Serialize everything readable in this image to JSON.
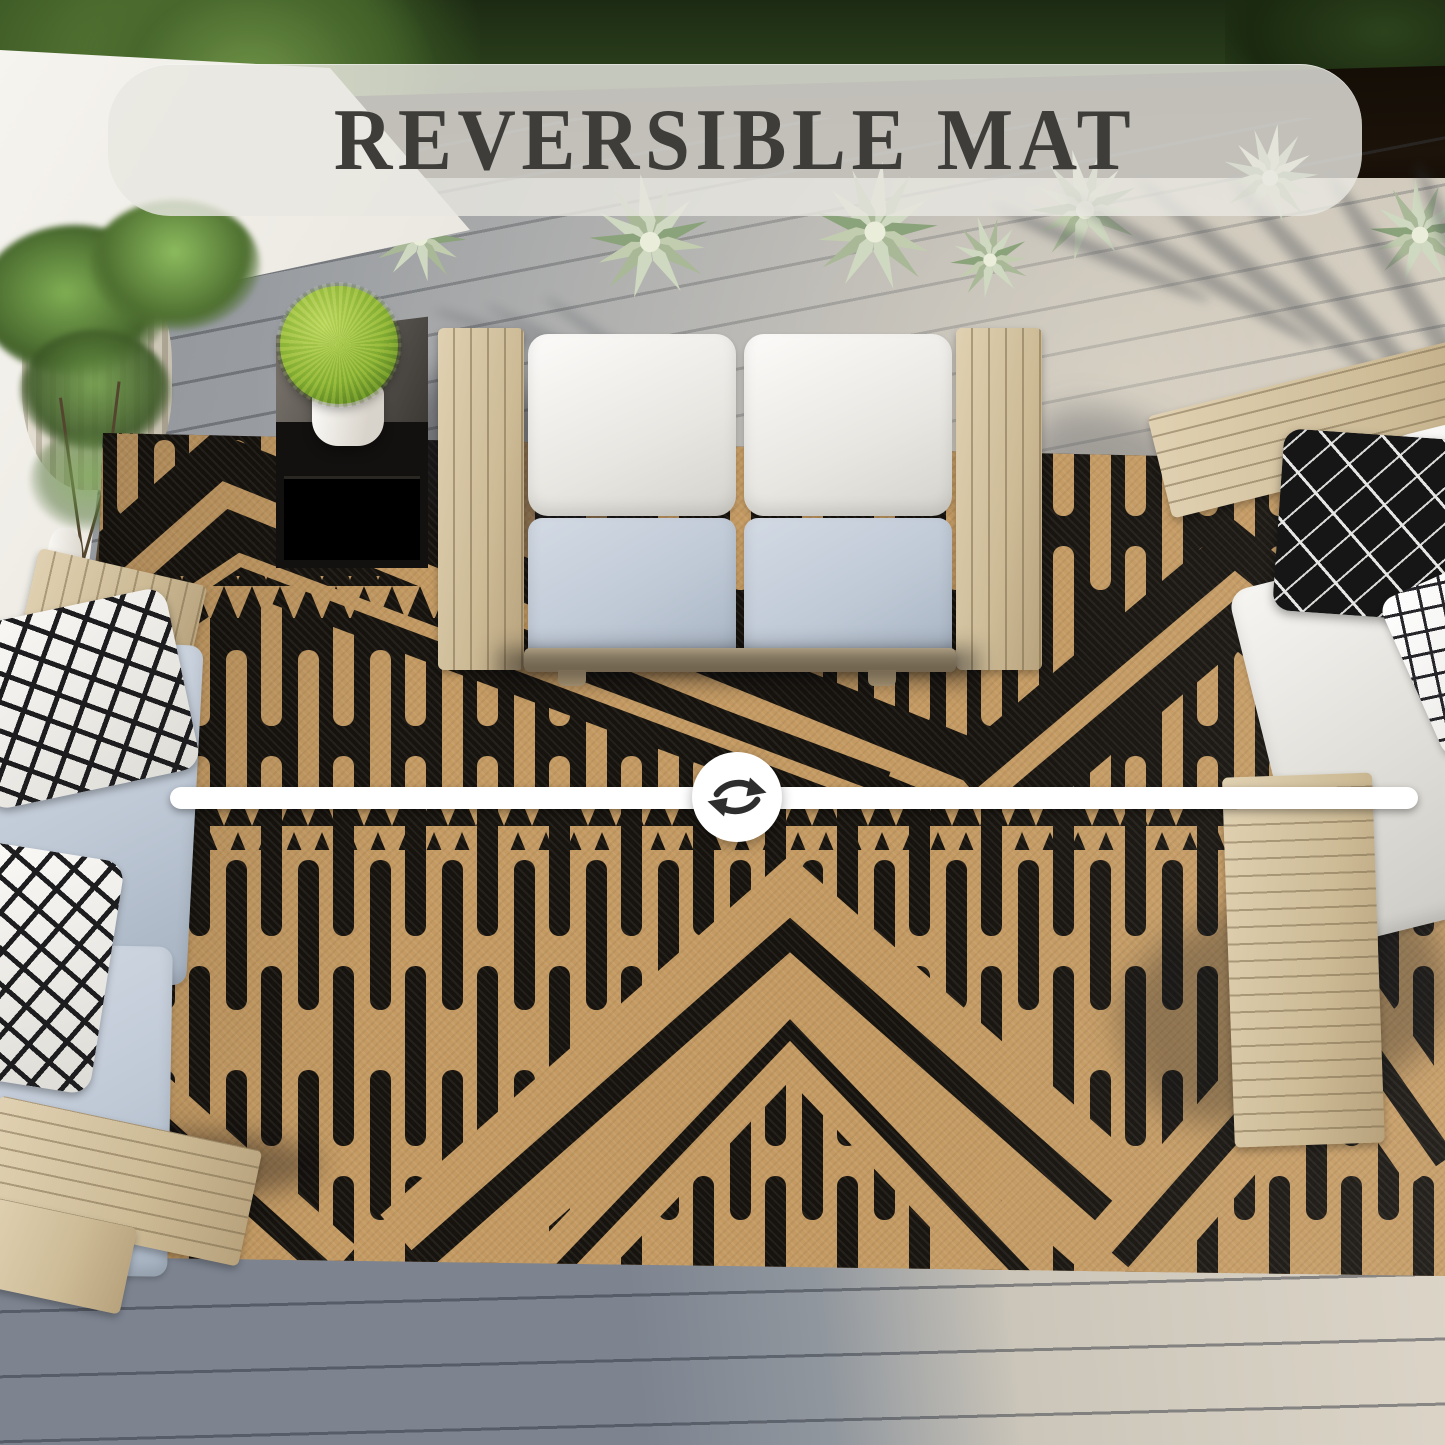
{
  "banner": {
    "label": "REVERSIBLE MAT"
  },
  "divider": {
    "icon": "swap-arrows-icon",
    "style": "white rounded bar across mat with circular badge"
  },
  "scene": {
    "type": "product-photo",
    "subject": "Top-down view of a reversible black and tan geometric outdoor mat on a patio deck; white bar with swap arrows divides the dark side (top) from the light side (bottom)",
    "elements": [
      "hedge",
      "agave-plants",
      "white-garden-wall",
      "ribbed-planter-pot",
      "sculptural-vase",
      "branch-plant",
      "black-side-table",
      "moss-ball-plant",
      "wooden-loveseat",
      "white-back-cushions",
      "blue-gray-seat-cushions",
      "right-armchair",
      "black-pattern-pillow",
      "white-grid-pillow",
      "left-sofa",
      "checkered-pillows",
      "reversible-mat-dark-side",
      "reversible-mat-light-side",
      "deck-boards",
      "palm-frond-shadows"
    ]
  },
  "colors": {
    "rug-black": "#17130e",
    "rug-tan": "#c49a62",
    "deck-gray": "#9aa0a6",
    "deck-sunlit": "#d8d1c5",
    "wood": "#d8c7a6",
    "cushion-white": "#f3f2ee",
    "cushion-blue": "#c3cdd9",
    "banner-bg": "rgba(232,231,224,0.82)",
    "banner-text": "#3e3d3a",
    "divider-white": "#ffffff",
    "foliage-dark": "#2c421d",
    "foliage-light": "#9cc23e",
    "arrow-dark": "#2e2e2e"
  }
}
